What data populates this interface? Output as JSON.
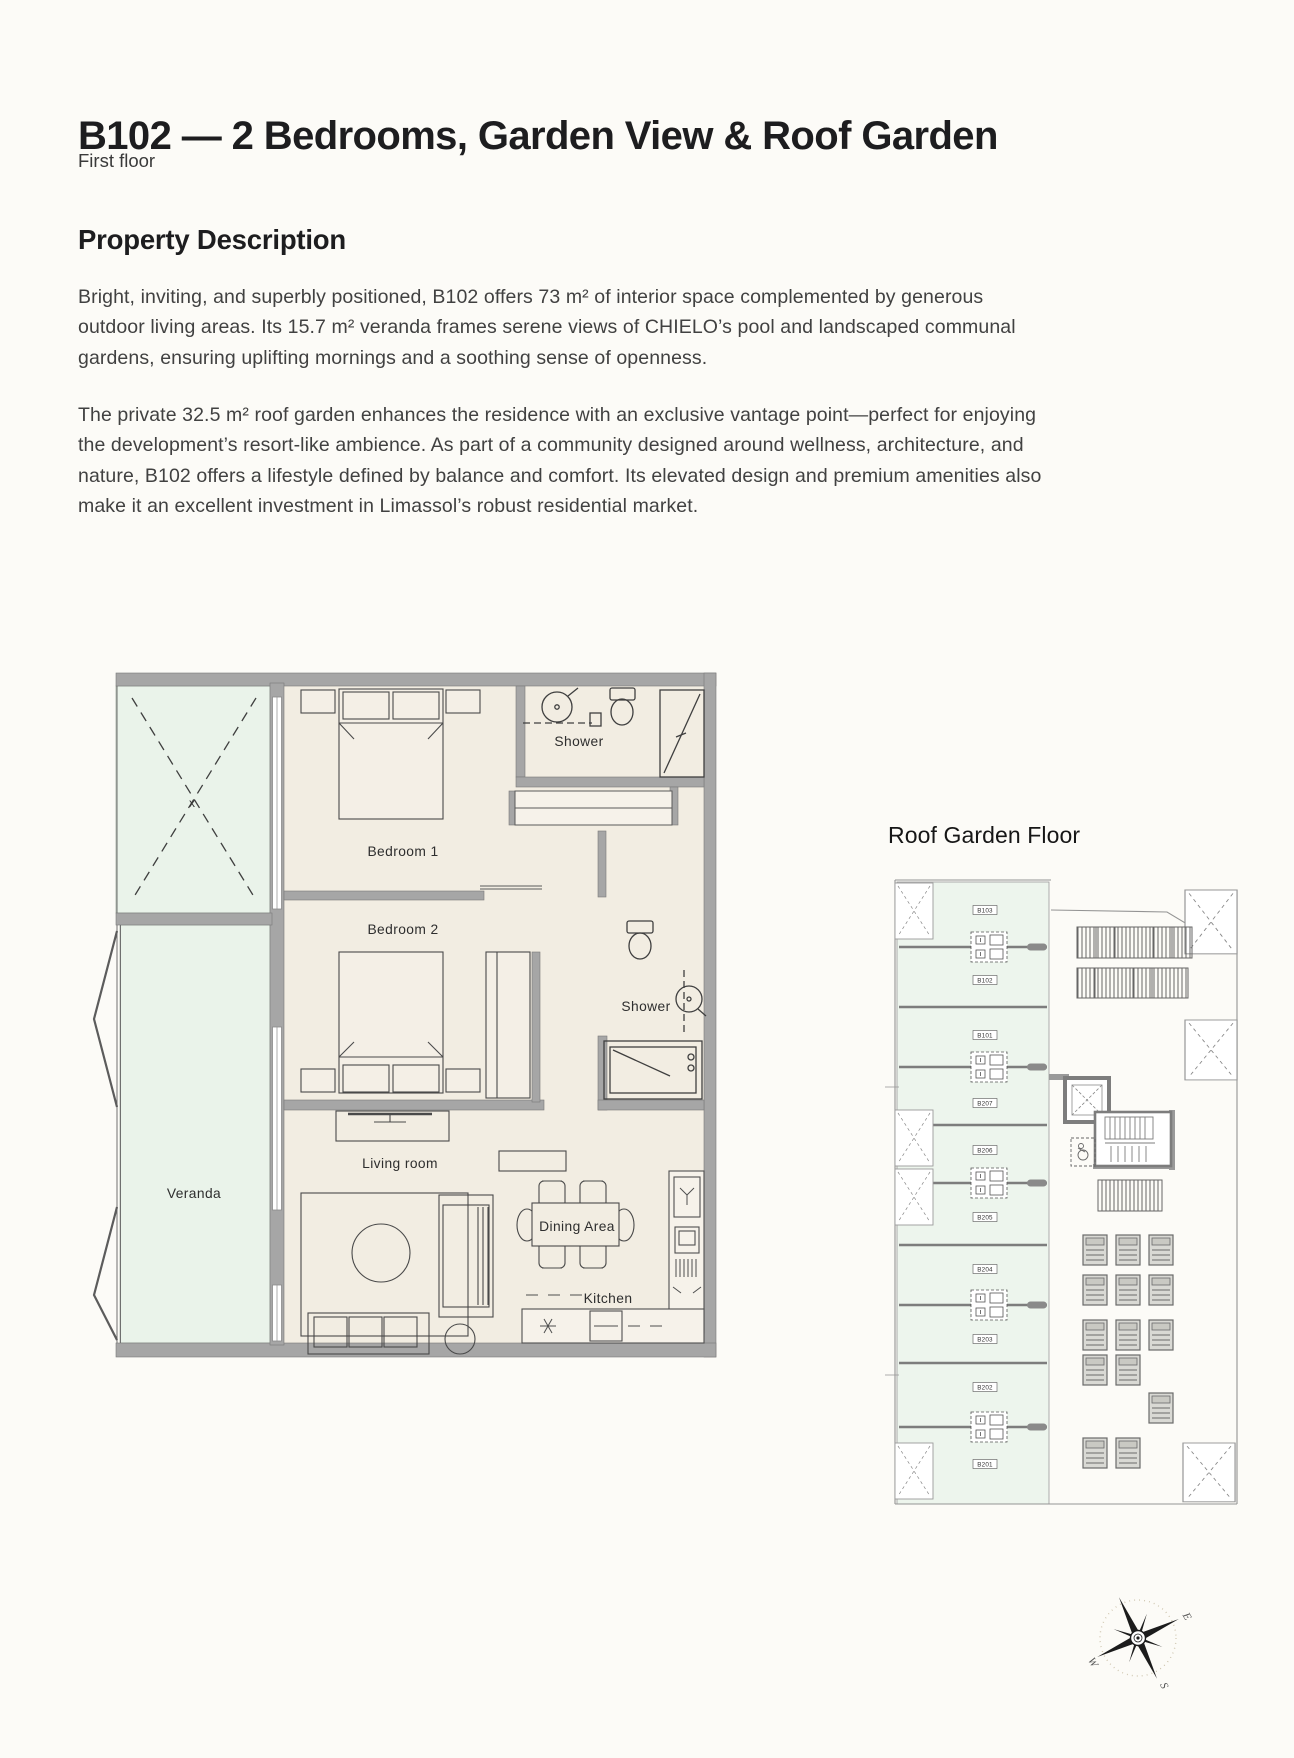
{
  "page": {
    "title": "B102 — 2 Bedrooms, Garden View & Roof Garden",
    "subtitle": "First floor"
  },
  "description": {
    "heading": "Property Description",
    "paragraphs": [
      "Bright, inviting, and superbly positioned, B102 offers 73 m² of interior space complemented by generous outdoor living areas. Its 15.7 m² veranda frames serene views of CHIELO’s pool and landscaped communal gardens, ensuring uplifting mornings and a soothing sense of openness.",
      "The private 32.5 m² roof garden enhances the residence with an exclusive vantage point—perfect for enjoying the development’s resort-like ambience. As part of a community designed around wellness, architecture, and nature, B102 offers a lifestyle defined by balance and comfort. Its elevated design and premium amenities also make it an excellent investment in Limassol’s robust residential market."
    ]
  },
  "floorplan": {
    "labels": {
      "shower_top": "Shower",
      "bedroom1": "Bedroom 1",
      "bedroom2": "Bedroom 2",
      "shower_mid": "Shower",
      "living": "Living room",
      "veranda": "Veranda",
      "dining": "Dining Area",
      "kitchen": "Kitchen",
      "garden_mark": "x"
    }
  },
  "roofplan": {
    "title": "Roof Garden Floor",
    "units": [
      "B103",
      "B102",
      "B101",
      "B207",
      "B206",
      "B205",
      "B204",
      "B203",
      "B202",
      "B201"
    ]
  },
  "compass": {
    "east": "E",
    "west": "W",
    "south": "S"
  },
  "colors": {
    "plan_interior": "#f2ede2",
    "outdoor_mint": "#eaf3ea",
    "roof_terrace_mint": "#edf5ed",
    "wall_gray": "#a6a6a6",
    "line_dark": "#4a4a4a"
  }
}
